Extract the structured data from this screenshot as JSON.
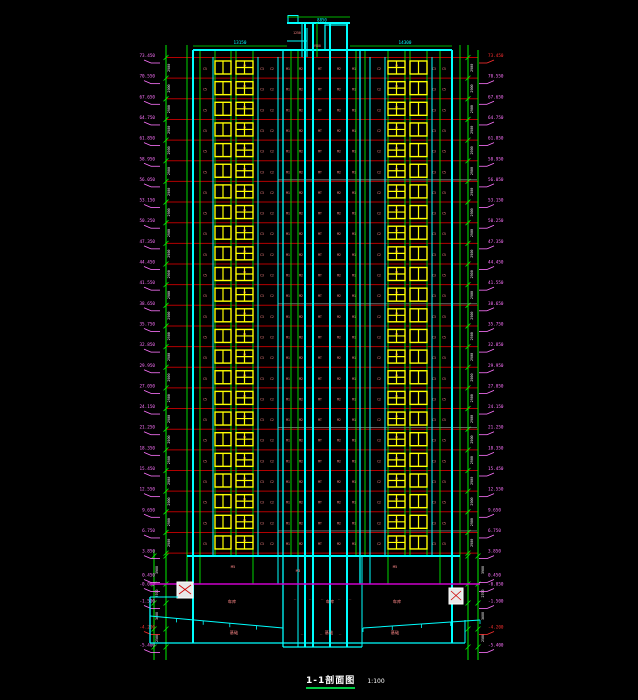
{
  "drawing": {
    "title": "1-1剖面图",
    "scale": "1:100",
    "floor_height_dim": "2900",
    "levels": [
      "73.450",
      "70.550",
      "67.650",
      "64.750",
      "61.850",
      "58.950",
      "56.050",
      "53.150",
      "50.250",
      "47.350",
      "44.450",
      "41.550",
      "38.650",
      "35.750",
      "32.850",
      "29.950",
      "27.050",
      "24.150",
      "21.250",
      "18.350",
      "15.450",
      "12.550",
      "9.650",
      "6.750",
      "3.850"
    ],
    "bottom_levels": [
      {
        "y": 577,
        "v": "0.450",
        "red": false
      },
      {
        "y": 586,
        "v": "-0.050",
        "red": false
      },
      {
        "y": 603,
        "v": "-1.500",
        "red": false
      },
      {
        "y": 629,
        "v": "-4.200",
        "red": true
      },
      {
        "y": 647,
        "v": "-5.400",
        "red": false
      }
    ],
    "bottom_dims": [
      "3900",
      "2700",
      "3600",
      "2500"
    ],
    "row_tags": [
      {
        "x": 205,
        "t": "C5"
      },
      {
        "x": 262,
        "t": "C3"
      },
      {
        "x": 272,
        "t": "C2"
      },
      {
        "x": 288,
        "t": "M1"
      },
      {
        "x": 301,
        "t": "M2"
      },
      {
        "x": 320,
        "t": "MT"
      },
      {
        "x": 339,
        "t": "M2"
      },
      {
        "x": 354,
        "t": "M1"
      },
      {
        "x": 379,
        "t": "C2"
      },
      {
        "x": 434,
        "t": "C3"
      },
      {
        "x": 444,
        "t": "C5"
      }
    ],
    "window_tag": "C4",
    "roof": {
      "top_dim": "8850",
      "tag_a": "1250",
      "tag_b": "2900",
      "parapet_left": "13150",
      "parapet_right": "14300"
    },
    "podium_tags": [
      {
        "x": 233,
        "y": 568,
        "t": "M5"
      },
      {
        "x": 298,
        "y": 572,
        "t": "M3"
      },
      {
        "x": 395,
        "y": 568,
        "t": "M5"
      }
    ],
    "basement_tags": [
      {
        "x": 232,
        "y": 603,
        "t": "车库"
      },
      {
        "x": 330,
        "y": 603,
        "t": "车库"
      },
      {
        "x": 397,
        "y": 603,
        "t": "车库"
      },
      {
        "x": 234,
        "y": 634,
        "t": "基础"
      },
      {
        "x": 329,
        "y": 634,
        "t": "基础"
      },
      {
        "x": 395,
        "y": 634,
        "t": "基础"
      }
    ],
    "tiny_tag_glyph": "··",
    "tiny_tags": [
      {
        "x": 295,
        "y": 600
      },
      {
        "x": 310,
        "y": 600
      },
      {
        "x": 322,
        "y": 600
      },
      {
        "x": 339,
        "y": 600
      },
      {
        "x": 350,
        "y": 600
      },
      {
        "x": 302,
        "y": 635
      },
      {
        "x": 321,
        "y": 635
      },
      {
        "x": 340,
        "y": 635
      }
    ],
    "colors": {
      "background": "#000000",
      "cyan": "#00ffff",
      "green": "#00ee00",
      "red": "#b40000",
      "yellow": "#ffff00",
      "pink": "#ff8888",
      "magenta": "#ff74ff",
      "white": "#ffffff",
      "gray": "#9aa0a0",
      "ground": "#cc00cc",
      "title_underline": "#00cc44"
    }
  }
}
